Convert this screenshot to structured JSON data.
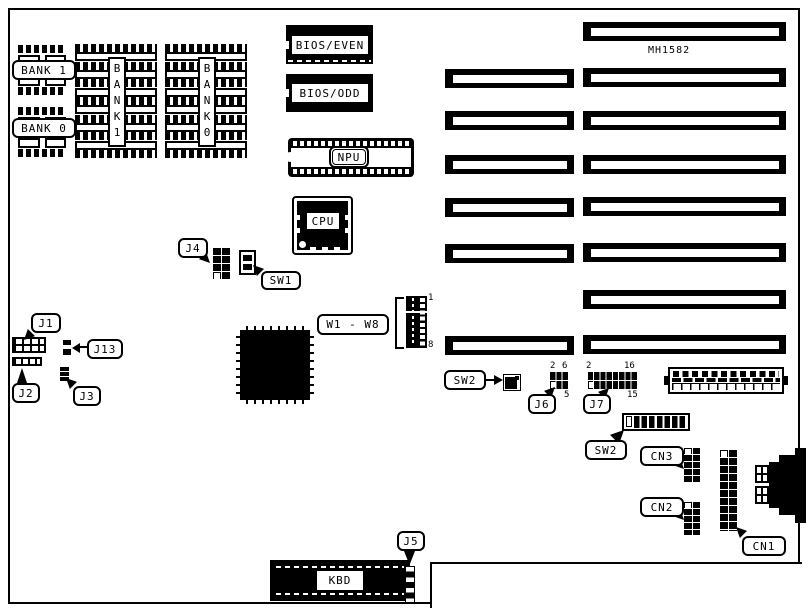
{
  "diagram": {
    "board_model": "MH1582",
    "memory": {
      "bank1": "BANK 1",
      "bank0": "BANK 0",
      "bank1_vertical": "BANK1",
      "bank0_vertical": "BANK0"
    },
    "chips": {
      "bios_even": "BIOS/EVEN",
      "bios_odd": "BIOS/ODD",
      "npu": "NPU",
      "cpu": "CPU",
      "keyboard": "KBD"
    },
    "jumpers": {
      "j1": "J1",
      "j2": "J2",
      "j3": "J3",
      "j4": "J4",
      "j5": "J5",
      "j6": "J6",
      "j7": "J7",
      "j13": "J13",
      "w_group": "W1 - W8"
    },
    "switches": {
      "sw1": "SW1",
      "sw2_a": "SW2",
      "sw2_b": "SW2"
    },
    "connectors": {
      "cn1": "CN1",
      "cn2": "CN2",
      "cn3": "CN3"
    },
    "pin_numbers": {
      "w_top": "1",
      "w_bottom": "8",
      "j6_top_left": "2",
      "j6_top_right": "6",
      "j6_bottom_right": "5",
      "j7_top_left": "2",
      "j7_top_right": "16",
      "j7_bottom_right": "15"
    },
    "colors": {
      "ink": "#000000",
      "paper": "#ffffff"
    }
  }
}
